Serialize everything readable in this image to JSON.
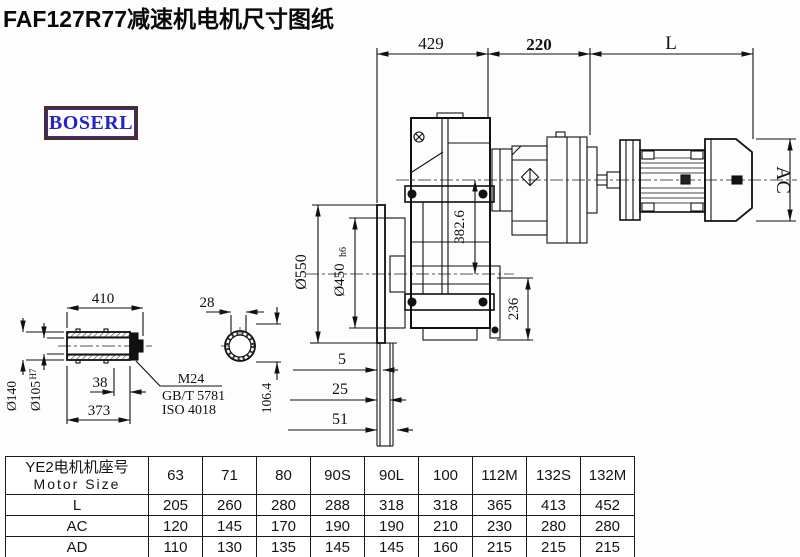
{
  "title": "FAF127R77减速机电机尺寸图纸",
  "logo": {
    "text": "BOSERL"
  },
  "drawing": {
    "top_dims": {
      "gearcase": "429",
      "adapter": "220",
      "motor_length": "L"
    },
    "motor_diameter": "AC",
    "center_height": "382.6",
    "foot_height": "236",
    "flange_od": "Ø550",
    "spigot": {
      "base": "Ø450",
      "tol": "h6"
    },
    "offsets": {
      "a": "5",
      "b": "25",
      "c": "51"
    },
    "shaft": {
      "overall": "410",
      "body": "373",
      "groove": "38",
      "od": "Ø140",
      "bore": {
        "base": "Ø105",
        "tol": "H7"
      },
      "bolt": "M24",
      "std1": "GB/T 5781",
      "std2": "ISO 4018",
      "key_width": "28",
      "across": "106.4"
    }
  },
  "table": {
    "header": {
      "cn": "YE2电机机座号",
      "en": "Motor Size"
    },
    "columns": [
      "63",
      "71",
      "80",
      "90S",
      "90L",
      "100",
      "112M",
      "132S",
      "132M"
    ],
    "rows": [
      {
        "label": "L",
        "values": [
          "205",
          "260",
          "280",
          "288",
          "318",
          "318",
          "365",
          "413",
          "452"
        ]
      },
      {
        "label": "AC",
        "values": [
          "120",
          "145",
          "170",
          "190",
          "190",
          "210",
          "230",
          "280",
          "280"
        ]
      },
      {
        "label": "AD",
        "values": [
          "110",
          "130",
          "135",
          "145",
          "145",
          "160",
          "215",
          "215",
          "215"
        ]
      }
    ]
  }
}
